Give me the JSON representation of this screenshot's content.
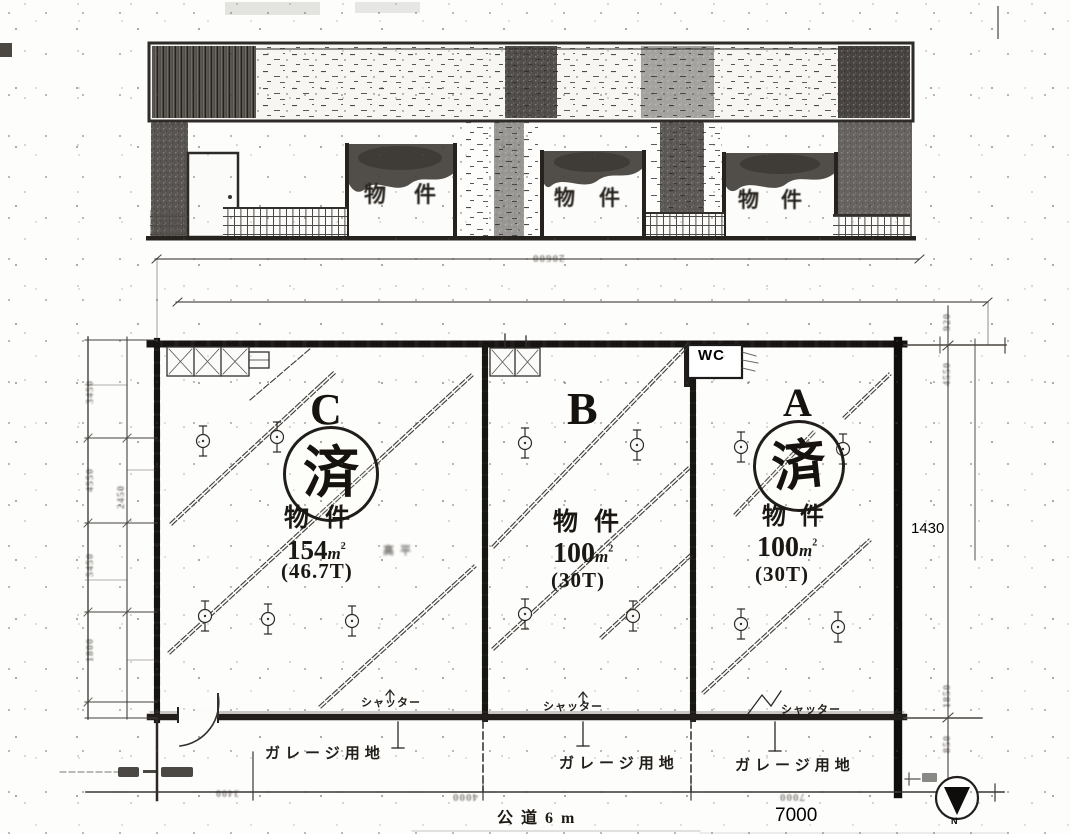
{
  "elevation": {
    "signs": [
      {
        "label": "物件"
      },
      {
        "label": "物件"
      },
      {
        "label": "物件"
      }
    ]
  },
  "plan": {
    "units": [
      {
        "letter": "C",
        "stamp": "済",
        "label": "物件",
        "area": "154",
        "unit_base": "m",
        "unit_exp": "2",
        "tsubo": "(46.7T)",
        "note": "高平",
        "sold": true,
        "shutter": "シャッター",
        "garage": "ガレージ用地"
      },
      {
        "letter": "B",
        "label": "物件",
        "area": "100",
        "unit_base": "m",
        "unit_exp": "2",
        "tsubo": "(30T)",
        "sold": false,
        "shutter": "シャッター",
        "garage": "ガレージ用地"
      },
      {
        "letter": "A",
        "stamp": "済",
        "label": "物件",
        "area": "100",
        "unit_base": "m",
        "unit_exp": "2",
        "tsubo": "(30T)",
        "sold": true,
        "shutter": "シャッター",
        "garage": "ガレージ用地"
      }
    ],
    "labels": {
      "wc": "WC",
      "road": "公道6m",
      "width_dim": "7000",
      "side_dim": "1430",
      "compass_n": "N"
    },
    "faint_dims": {
      "top": "20600",
      "bottom_left": "4000",
      "bottom_right": "7000",
      "corner": "3400",
      "left_col": [
        "3450",
        "4550",
        "2450",
        "5450",
        "1800"
      ],
      "right_col": [
        "920",
        "4550",
        "1850",
        "850"
      ]
    }
  }
}
